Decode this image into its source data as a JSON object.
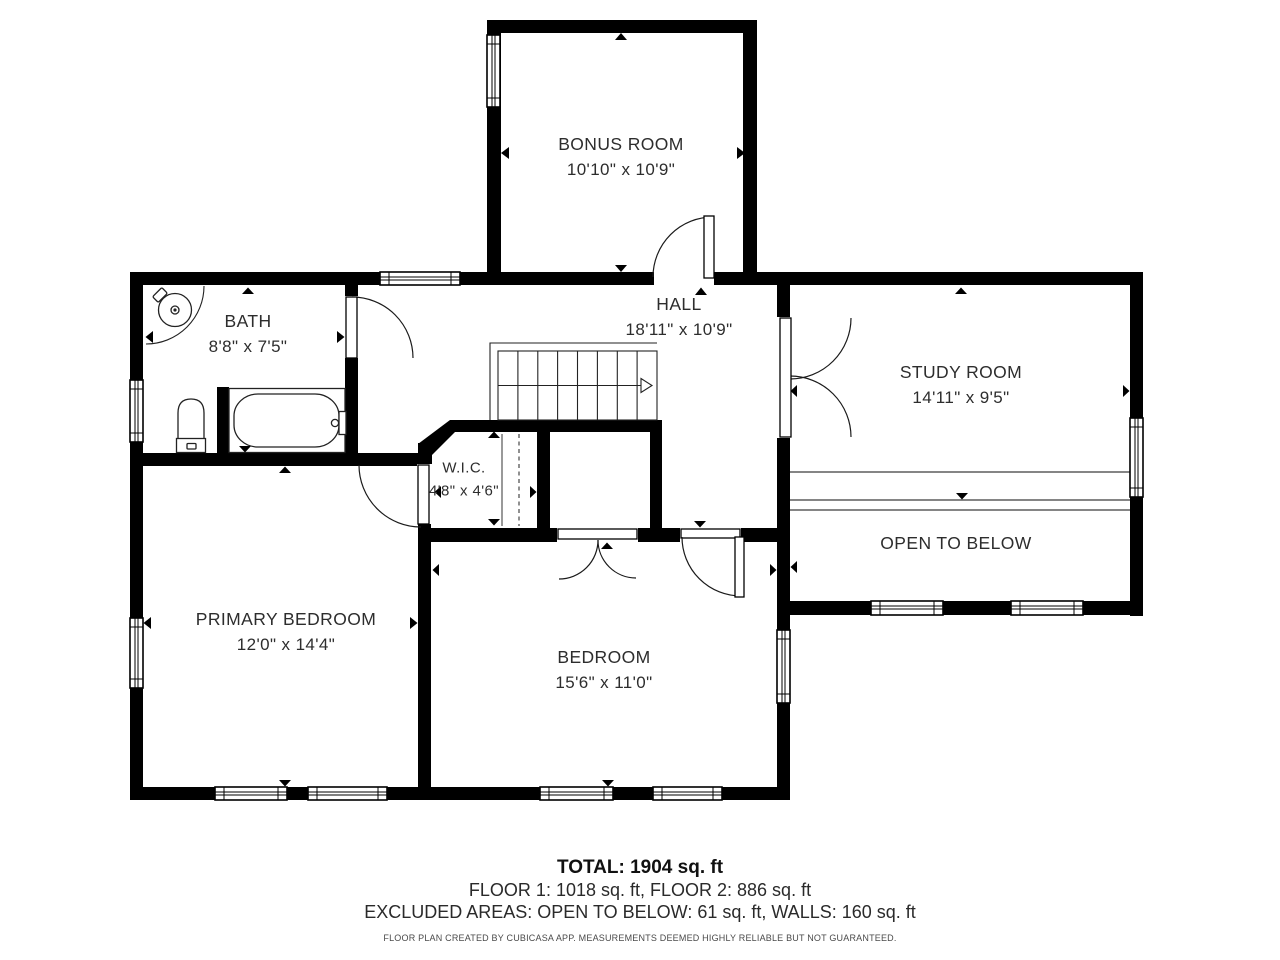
{
  "rooms": [
    {
      "id": "bonus-room",
      "name": "BONUS ROOM",
      "dims": "10'10\" x 10'9\""
    },
    {
      "id": "bath",
      "name": "BATH",
      "dims": "8'8\" x 7'5\""
    },
    {
      "id": "hall",
      "name": "HALL",
      "dims": "18'11\" x 10'9\""
    },
    {
      "id": "study-room",
      "name": "STUDY ROOM",
      "dims": "14'11\" x 9'5\""
    },
    {
      "id": "wic",
      "name": "W.I.C.",
      "dims": "4'8\" x 4'6\""
    },
    {
      "id": "open-to-below",
      "name": "OPEN TO BELOW",
      "dims": ""
    },
    {
      "id": "primary-bedroom",
      "name": "PRIMARY BEDROOM",
      "dims": "12'0\" x 14'4\""
    },
    {
      "id": "bedroom",
      "name": "BEDROOM",
      "dims": "15'6\" x 11'0\""
    }
  ],
  "summary": {
    "total": "TOTAL: 1904 sq. ft",
    "floors": "FLOOR 1: 1018 sq. ft, FLOOR 2: 886 sq. ft",
    "excluded": "EXCLUDED AREAS: OPEN TO BELOW: 61 sq. ft, WALLS: 160 sq. ft",
    "disclaimer": "FLOOR PLAN CREATED BY CUBICASA APP. MEASUREMENTS DEEMED HIGHLY RELIABLE BUT NOT GUARANTEED."
  },
  "colors": {
    "walls": "#000000",
    "lines": "#222222",
    "text": "#2d2d2d",
    "background": "#ffffff"
  }
}
